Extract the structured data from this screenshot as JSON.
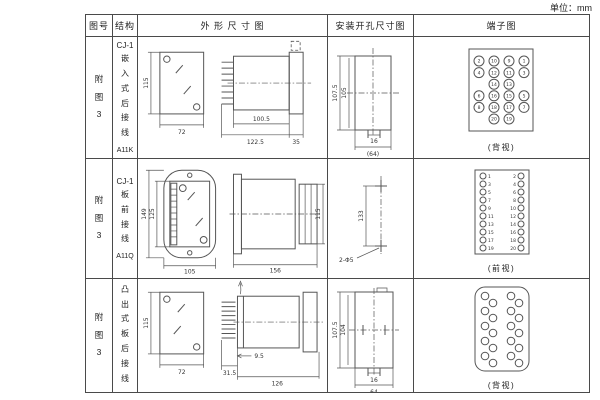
{
  "unit_label": "单位：mm",
  "headers": {
    "fig_no": "图号",
    "structure": "结构",
    "outline": "外 形 尺 寸 图",
    "install": "安装开孔尺寸图",
    "terminal": "端子图"
  },
  "rows": [
    {
      "fig": "附图3",
      "model": "CJ-1",
      "mount": "嵌入式后接线",
      "code": "A11K",
      "outline": {
        "front_height": "115",
        "front_width": "72",
        "body_depth": "100.5",
        "total_depth": "122.5",
        "flange_depth": "35"
      },
      "install": {
        "outer_height": "107.5",
        "inner_height": "105",
        "slot_width": "16",
        "cutout_width": "(64)"
      },
      "terminal": {
        "caption": "(背视)",
        "columns": [
          {
            "pins": [
              "2",
              "4",
              "6",
              "8"
            ],
            "slots": [
              0,
              1,
              3,
              4
            ]
          },
          {
            "pins": [
              "10",
              "12",
              "14",
              "16",
              "18",
              "20"
            ],
            "slots": [
              0,
              1,
              2,
              3,
              4,
              5
            ]
          },
          {
            "pins": [
              "9",
              "11",
              "13",
              "15",
              "17",
              "19"
            ],
            "slots": [
              0,
              1,
              2,
              3,
              4,
              5
            ]
          },
          {
            "pins": [
              "1",
              "3",
              "5",
              "7"
            ],
            "slots": [
              0,
              1,
              3,
              4
            ]
          }
        ]
      }
    },
    {
      "fig": "附图3",
      "model": "CJ-1",
      "mount": "板前接线",
      "code": "A11Q",
      "outline": {
        "outer_height": "149",
        "inner_height": "125",
        "front_width": "105",
        "total_depth": "156",
        "body_height": "115"
      },
      "install": {
        "hole_spacing": "133",
        "hole_label": "2-Φ5"
      },
      "terminal": {
        "caption": "(前视)",
        "left_pins": [
          "1",
          "3",
          "5",
          "7",
          "9",
          "11",
          "13",
          "15",
          "17",
          "19"
        ],
        "right_pins": [
          "2",
          "4",
          "6",
          "8",
          "10",
          "12",
          "14",
          "16",
          "18",
          "20"
        ]
      }
    },
    {
      "fig": "附图3",
      "model": "CJ-1",
      "mount": "凸出式板后接线",
      "code": "A11H",
      "outline": {
        "front_height": "115",
        "front_width": "72",
        "pin_depth": "31.5",
        "step_depth": "9.5",
        "total_depth": "126"
      },
      "install": {
        "outer_height": "107.5",
        "inner_height": "104",
        "slot_width": "16",
        "cutout_width": "64"
      },
      "terminal": {
        "caption": "(背视)",
        "pin_count": 20
      }
    }
  ]
}
